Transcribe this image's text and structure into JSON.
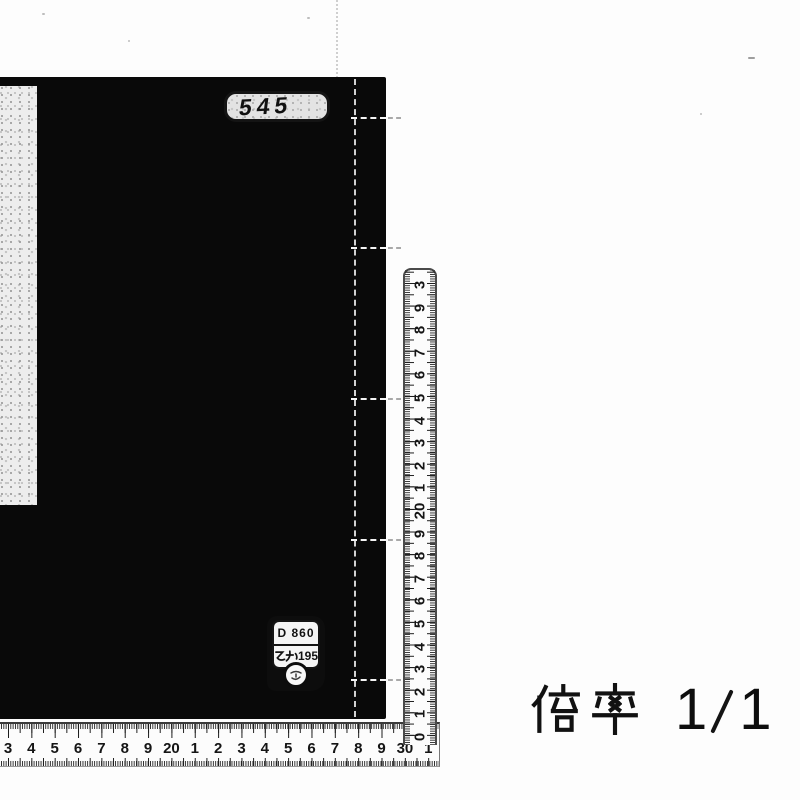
{
  "scan": {
    "book": {
      "call_number": "545",
      "id_plate": {
        "line1": "D 860",
        "line2_prefix": "乙か",
        "line2_number": "195"
      }
    },
    "magnification": {
      "label": "倍率",
      "value": "1／1",
      "numerator": "1",
      "denominator": "1"
    },
    "rulers": {
      "horizontal_numbers": [
        "3",
        "4",
        "5",
        "6",
        "7",
        "8",
        "9",
        "20",
        "1",
        "2",
        "3",
        "4",
        "5",
        "6",
        "7",
        "8",
        "9",
        "30",
        "1"
      ],
      "vertical_numbers": [
        "3",
        "9",
        "8",
        "7",
        "6",
        "5",
        "4",
        "3",
        "2",
        "1",
        "20",
        "9",
        "8",
        "7",
        "6",
        "5",
        "4",
        "3",
        "2",
        "1",
        "0"
      ]
    }
  }
}
